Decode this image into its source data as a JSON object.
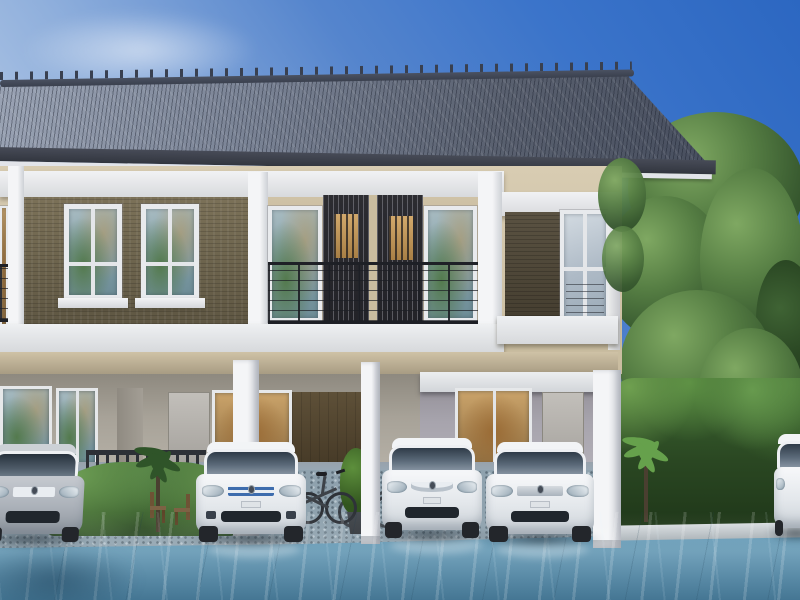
{
  "scene": {
    "title": "3D architectural rendering of a modern two-storey townhouse row with carports, four white and silver cars, bicycles, hedges, a large tree and a glossy blue driveway under a clear blue sky",
    "sky": {
      "top_right_color": "#2c67c1",
      "lower_left_color": "#d6e1f0",
      "clouds": "thin white wisps"
    },
    "building": {
      "storeys": 2,
      "roof": {
        "type": "hipped tile roof",
        "color": "#59606f",
        "ridge_color": "#3a404e",
        "fascia_color": "#32363f"
      },
      "walls": {
        "upper_color": "#d0c3a8",
        "trim_color": "#eef0f2",
        "brick_accent_color": "#5f5743",
        "ground_wall_color": "#a7a298"
      },
      "features": [
        "white pilasters and horizontal beams",
        "dark brown brick feature panels with white-framed windows",
        "recessed balcony with dark metal railing",
        "two dark vertical louver screens with warm lit windows behind",
        "white carport posts",
        "glass doors with green and warm interior reflections",
        "dark brown timber wall panel"
      ]
    },
    "vehicles": [
      {
        "name": "silver-sedan",
        "color": "#aab0b8",
        "position": "far left, partially cropped"
      },
      {
        "name": "white-sedan-blue-grille",
        "color": "#f2f4f6",
        "grille": "#3d6cad",
        "position": "left carport"
      },
      {
        "name": "white-hatchback-chrome-grille",
        "color": "#f2f4f6",
        "position": "middle carport"
      },
      {
        "name": "white-minivan",
        "color": "#f2f4f6",
        "position": "right carport"
      },
      {
        "name": "white-car-partial",
        "color": "#f2f4f6",
        "position": "far right edge"
      }
    ],
    "objects": [
      "two bicycles leaning near middle post",
      "outdoor wooden chairs",
      "potted palm plants",
      "dark picket fence"
    ],
    "vegetation": {
      "tree_color": "#557d43",
      "hedge_color": "#2c4a24",
      "items": [
        "large leafy tree on the right",
        "tall hedge wall on the right",
        "low rounded hedge on the left",
        "small palms and potted plants"
      ]
    },
    "ground": {
      "gravel_color": "#8fa2ae",
      "driveway_color": "#659ab6",
      "finish": "glossy blue with light streaks",
      "curb_color": "#d8dde0"
    }
  }
}
